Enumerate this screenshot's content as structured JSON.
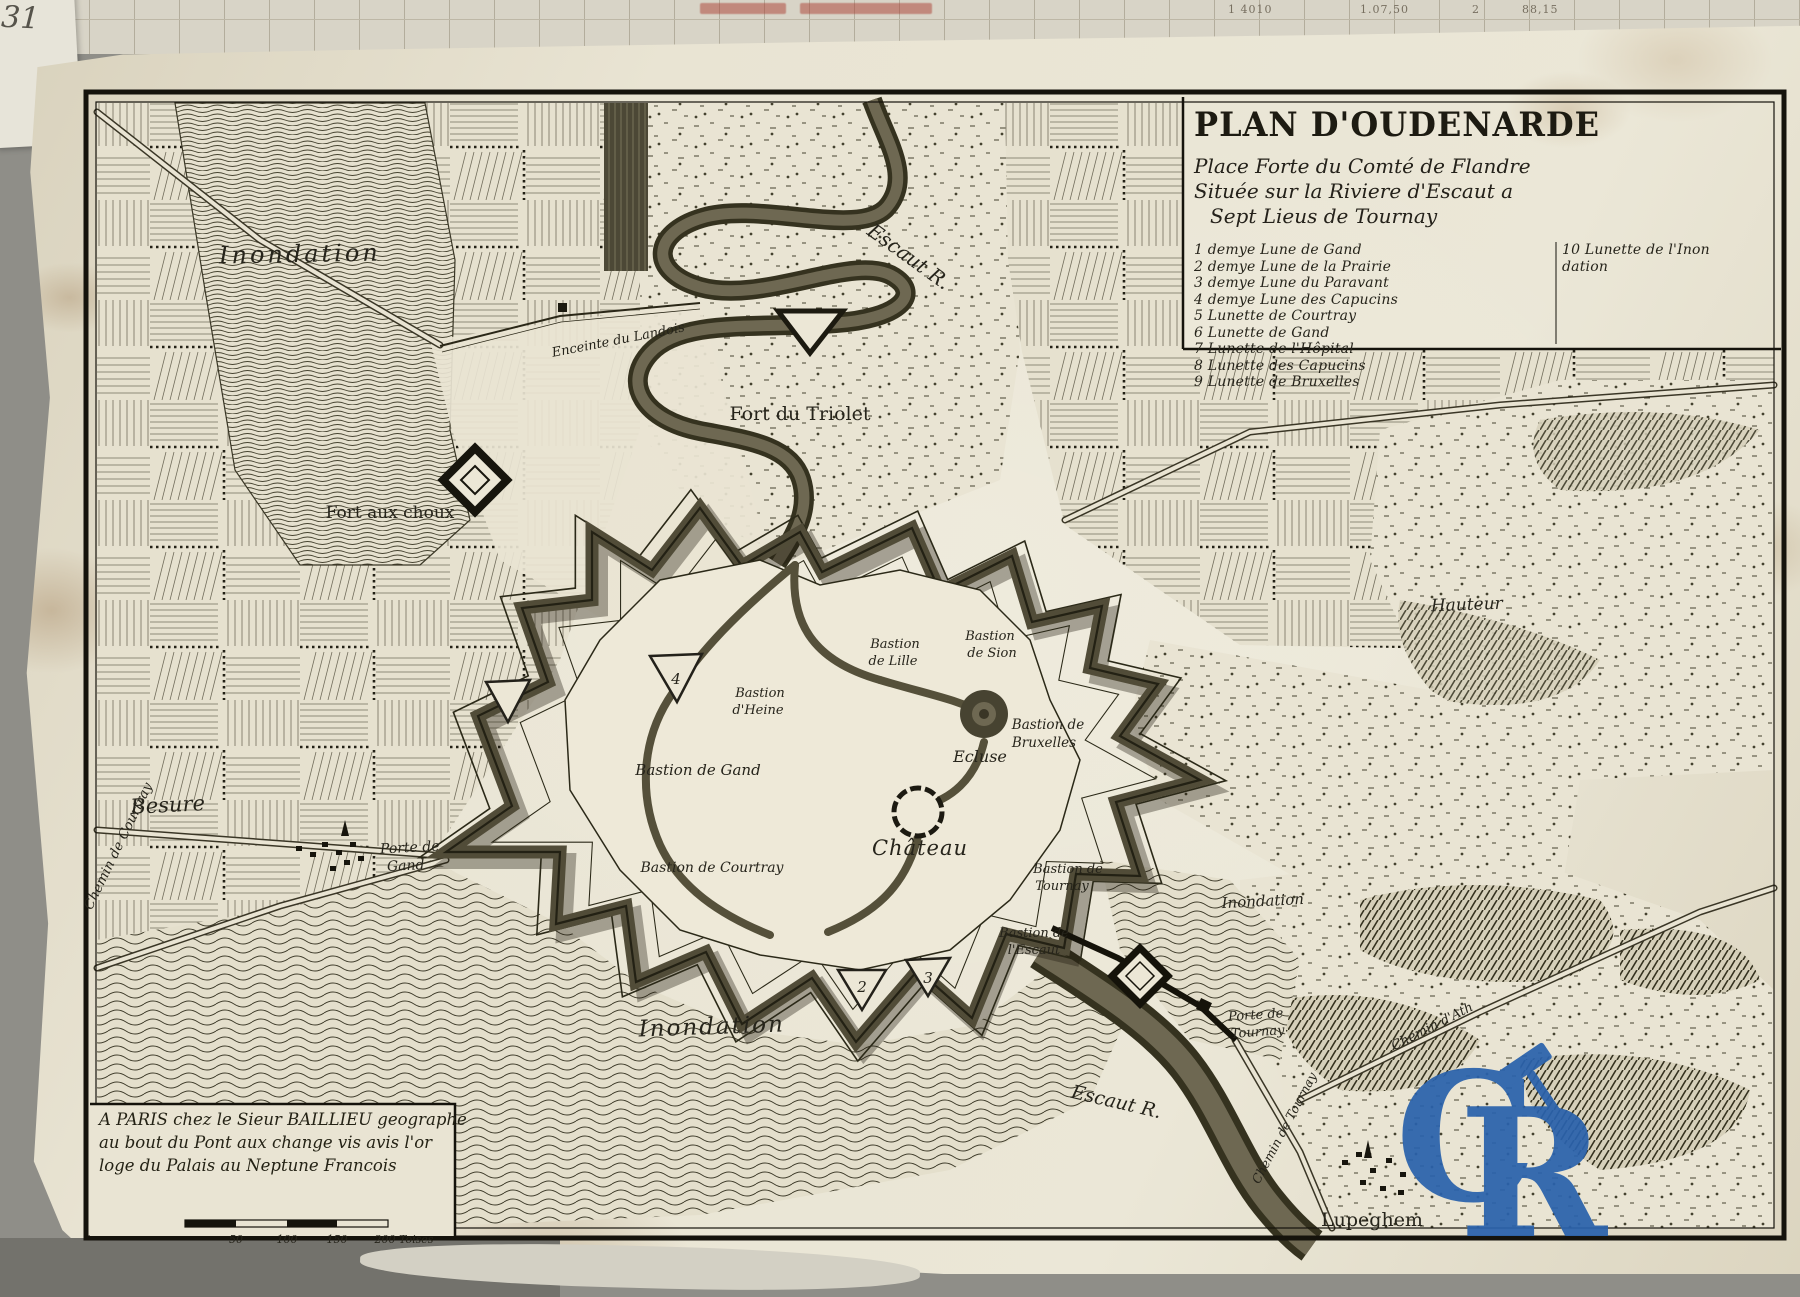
{
  "photo": {
    "handwritten_corner": "31",
    "background_numbers": [
      "1 4010",
      "1.07,50",
      "2",
      "88,15"
    ]
  },
  "title_block": {
    "title": "PLAN D'OUDENARDE",
    "subtitle_lines": [
      "Place Forte du Comté de Flandre",
      "Située sur la Riviere d'Escaut a",
      "Sept Lieus de Tournay"
    ],
    "legend_left": [
      "1 demye Lune de Gand",
      "2 demye Lune de la Prairie",
      "3 demye Lune du Paravant",
      "4 demye Lune des Capucins",
      "5 Lunette de Courtray",
      "6 Lunette de Gand",
      "7 Lunette de l'Hôpital",
      "8 Lunette des Capucins",
      "9 Lunette de Bruxelles"
    ],
    "legend_right": [
      "10 Lunette de l'Inon",
      "dation"
    ]
  },
  "imprint": {
    "lines": [
      "A PARIS chez le Sieur BAILLIEU geographe",
      "au bout du Pont aux change vis avis l'or",
      "loge du Palais au Neptune Francois"
    ]
  },
  "scale_bar": {
    "t1": "50",
    "t2": "100",
    "t3": "150",
    "t4": "200 Toises"
  },
  "labels": {
    "inondation_nw": "Inondation",
    "escaut_r_top": "Escaut R.",
    "enceinte": "Enceinte du Landois",
    "fort_triolet": "Fort du Triolet",
    "fort_aux_choux": "Fort aux choux",
    "besure": "Besure",
    "porte_gand_1": "Porte de",
    "porte_gand_2": "Gand",
    "chemin_courtray": "Chemin de Courtray",
    "bastion_lille_1": "Bastion",
    "bastion_lille_2": "de Lille",
    "bastion_sion_1": "Bastion",
    "bastion_sion_2": "de Sion",
    "bastion_heine_1": "Bastion",
    "bastion_heine_2": "d'Heine",
    "bastion_gand": "Bastion de Gand",
    "bastion_courtray": "Bastion de Courtray",
    "ecluse": "Ecluse",
    "chateau": "Château",
    "bastion_bruxelles_1": "Bastion de",
    "bastion_bruxelles_2": "Bruxelles",
    "bastion_tournay_1": "Bastion de",
    "bastion_tournay_2": "Tournay",
    "bastion_escaut_1": "Bastion de",
    "bastion_escaut_2": "l'Escaut",
    "inondation_e": "Inondation",
    "porte_tournay_1": "Porte de",
    "porte_tournay_2": "Tournay",
    "chemin_ath": "Chemin d'Ath",
    "chemin_tournay": "Chemin de Tournay",
    "escaut_r_bottom": "Escaut R.",
    "inondation_s": "Inondation",
    "lupeghem": "Lupeghem",
    "hauteur": "Hauteur",
    "marker_2": "2",
    "marker_3": "3",
    "marker_4": "4"
  },
  "watermark": {
    "c": "C",
    "r": "R",
    "color": "#2a62ac"
  },
  "colors": {
    "paper": "#e9e4d3",
    "ink": "#24211a",
    "watermark_blue": "#2a62ac"
  }
}
